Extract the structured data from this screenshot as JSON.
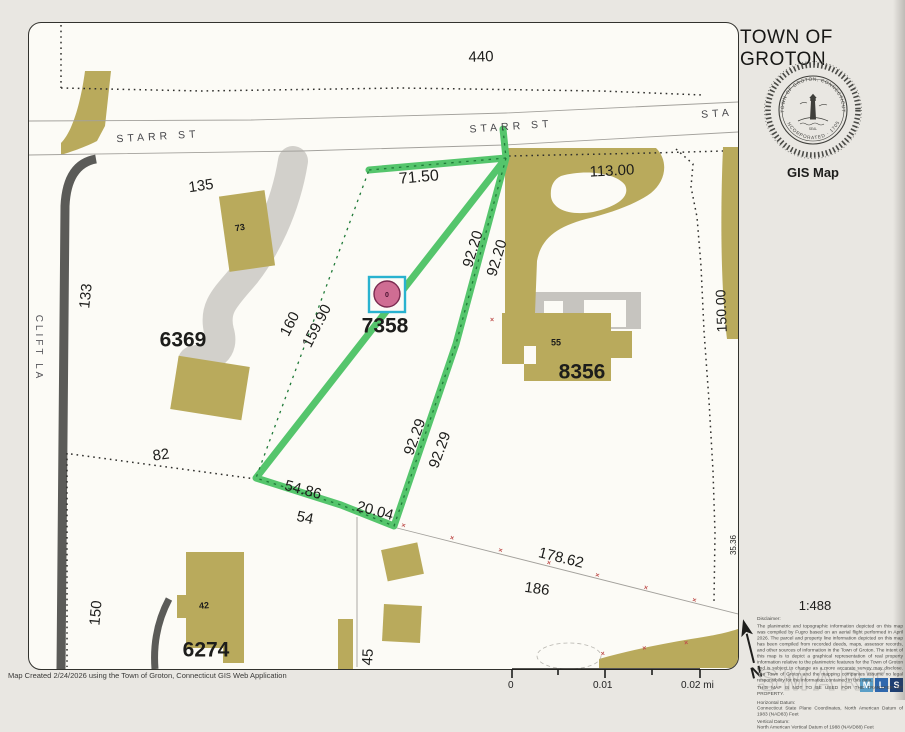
{
  "header": {
    "title": "TOWN OF GROTON",
    "map_type_label": "GIS Map",
    "seal": {
      "ring_text_top": "TOWN OF GROTON, CONNECTICUT",
      "ring_text_bottom": "INCORPORATED · 1705",
      "seal_word": "SEAL"
    }
  },
  "map": {
    "selected_parcel_id": "7358",
    "marker": {
      "symbol": "0"
    },
    "colors": {
      "highlight_green": "#55c56c",
      "highlight_dash": "#1f7a38",
      "marker_pink": "#cf6d93",
      "marker_outline": "#7a2a50",
      "marker_box_cyan": "#29b2cf",
      "building_olive": "#b9aa5c",
      "driveway_gray": "#d2d0cb",
      "road_dark": "#5b5b58",
      "red_x": "#bf4f4c"
    },
    "labels": [
      {
        "name": "street-label-starr-st-west",
        "text": "STARR ST",
        "x": 158,
        "y": 137,
        "rot": -3.5,
        "size": 10.5,
        "ls": 4,
        "color": "#46464a"
      },
      {
        "name": "street-label-starr-st-east",
        "text": "STARR ST",
        "x": 511,
        "y": 127,
        "rot": -4,
        "size": 10.5,
        "ls": 4,
        "color": "#46464a"
      },
      {
        "name": "street-label-sta-clipped",
        "text": "STA",
        "x": 717,
        "y": 114,
        "rot": -4,
        "size": 10.5,
        "ls": 4,
        "color": "#46464a"
      },
      {
        "name": "street-label-clift-la",
        "text": "CLIFT LA",
        "x": 38,
        "y": 348,
        "rot": 90,
        "size": 10,
        "ls": 3,
        "color": "#55555a"
      },
      {
        "name": "dimension-label",
        "text": "440",
        "x": 481,
        "y": 57,
        "rot": -2,
        "size": 15
      },
      {
        "name": "dimension-label",
        "text": "113.00",
        "x": 612,
        "y": 171,
        "rot": -3,
        "size": 15
      },
      {
        "name": "dimension-label",
        "text": "135",
        "x": 201,
        "y": 186,
        "rot": -8,
        "size": 15
      },
      {
        "name": "building-number",
        "text": "73",
        "x": 240,
        "y": 228,
        "rot": -10,
        "size": 9,
        "bold": true
      },
      {
        "name": "dimension-label",
        "text": "133",
        "x": 86,
        "y": 296,
        "rot": -84,
        "size": 15
      },
      {
        "name": "parcel-id-label",
        "text": "6369",
        "x": 183,
        "y": 340,
        "rot": 0,
        "size": 21,
        "bold": true
      },
      {
        "name": "dimension-label",
        "text": "160",
        "x": 290,
        "y": 324,
        "rot": -63,
        "size": 15
      },
      {
        "name": "dimension-label",
        "text": "159.90",
        "x": 317,
        "y": 326,
        "rot": -63,
        "size": 15
      },
      {
        "name": "dimension-label",
        "text": "71.50",
        "x": 419,
        "y": 178,
        "rot": -5,
        "size": 16
      },
      {
        "name": "dimension-label",
        "text": "92.20",
        "x": 473,
        "y": 249,
        "rot": -73,
        "size": 15
      },
      {
        "name": "dimension-label",
        "text": "92.20",
        "x": 497,
        "y": 258,
        "rot": -73,
        "size": 15
      },
      {
        "name": "parcel-id-label-selected",
        "text": "7358",
        "x": 385,
        "y": 326,
        "rot": 0,
        "size": 21,
        "bold": true
      },
      {
        "name": "building-number",
        "text": "55",
        "x": 556,
        "y": 343,
        "rot": 0,
        "size": 9,
        "bold": true
      },
      {
        "name": "parcel-id-label",
        "text": "8356",
        "x": 582,
        "y": 372,
        "rot": 0,
        "size": 21,
        "bold": true
      },
      {
        "name": "dimension-label",
        "text": "92.29",
        "x": 415,
        "y": 437,
        "rot": -70,
        "size": 15
      },
      {
        "name": "dimension-label",
        "text": "92.29",
        "x": 440,
        "y": 450,
        "rot": -70,
        "size": 15
      },
      {
        "name": "dimension-label",
        "text": "82",
        "x": 161,
        "y": 455,
        "rot": -8,
        "size": 15
      },
      {
        "name": "dimension-label",
        "text": "54.86",
        "x": 303,
        "y": 490,
        "rot": 15,
        "size": 15
      },
      {
        "name": "dimension-label",
        "text": "20.04",
        "x": 375,
        "y": 511,
        "rot": 15,
        "size": 15
      },
      {
        "name": "dimension-label",
        "text": "54",
        "x": 305,
        "y": 518,
        "rot": 12,
        "size": 15
      },
      {
        "name": "dimension-label",
        "text": "150",
        "x": 96,
        "y": 613,
        "rot": -85,
        "size": 15
      },
      {
        "name": "building-number",
        "text": "42",
        "x": 204,
        "y": 606,
        "rot": -5,
        "size": 9,
        "bold": true
      },
      {
        "name": "parcel-id-label",
        "text": "6274",
        "x": 206,
        "y": 650,
        "rot": 0,
        "size": 21,
        "bold": true
      },
      {
        "name": "dimension-label",
        "text": "178.62",
        "x": 561,
        "y": 558,
        "rot": 14,
        "size": 15
      },
      {
        "name": "dimension-label",
        "text": "186",
        "x": 537,
        "y": 589,
        "rot": 8,
        "size": 15
      },
      {
        "name": "dimension-label",
        "text": "45",
        "x": 368,
        "y": 657,
        "rot": -87,
        "size": 15
      },
      {
        "name": "dimension-label",
        "text": "150.00",
        "x": 721,
        "y": 311,
        "rot": -92,
        "size": 14
      },
      {
        "name": "dimension-label-clipped",
        "text": "35.36",
        "x": 734,
        "y": 545,
        "rot": -90,
        "size": 8
      }
    ]
  },
  "scalebar": {
    "tick0": "0",
    "tick1": "0.01",
    "tick2": "0.02 mi"
  },
  "north_arrow": {
    "label": "N"
  },
  "footer": {
    "created_note": "Map Created 2/24/2026 using the Town of Groton, Connecticut GIS Web Application",
    "scale_ratio": "1:488",
    "disclaimer_title": "Disclaimer:",
    "disclaimer_body": "The planimetric and topographic information depicted on this map was compiled by Fugro based on an aerial flight performed in April 2026. The parcel and property line information depicted on this map has been compiled from recorded deeds, maps, assessor records, and other sources of information in the Town of Groton. The intent of this map is to depict a graphical representation of real property information relative to the planimetric features for the Town of Groton and is subject to change as a more accurate survey may disclose. The Town of Groton and the mapping companies assume no legal responsibility for the information contained in this data.",
    "transfer_caps": "THIS MAP IS NOT TO BE USED FOR THE TRANSFER OF PROPERTY.",
    "h_datum_label": "Horizontal Datum:",
    "h_datum": "Connecticut State Plane Coordinates, North American Datum of 1983 (NAD83) Feet",
    "v_datum_label": "Vertical Datum:",
    "v_datum": "North American Vertical Datum of 1988 (NAVD88) Feet",
    "smart_logo": {
      "word": "SMART",
      "squares": [
        "M",
        "L",
        "S"
      ],
      "square_colors": [
        "#5b9fc7",
        "#3068ad",
        "#1d3f74"
      ]
    }
  }
}
